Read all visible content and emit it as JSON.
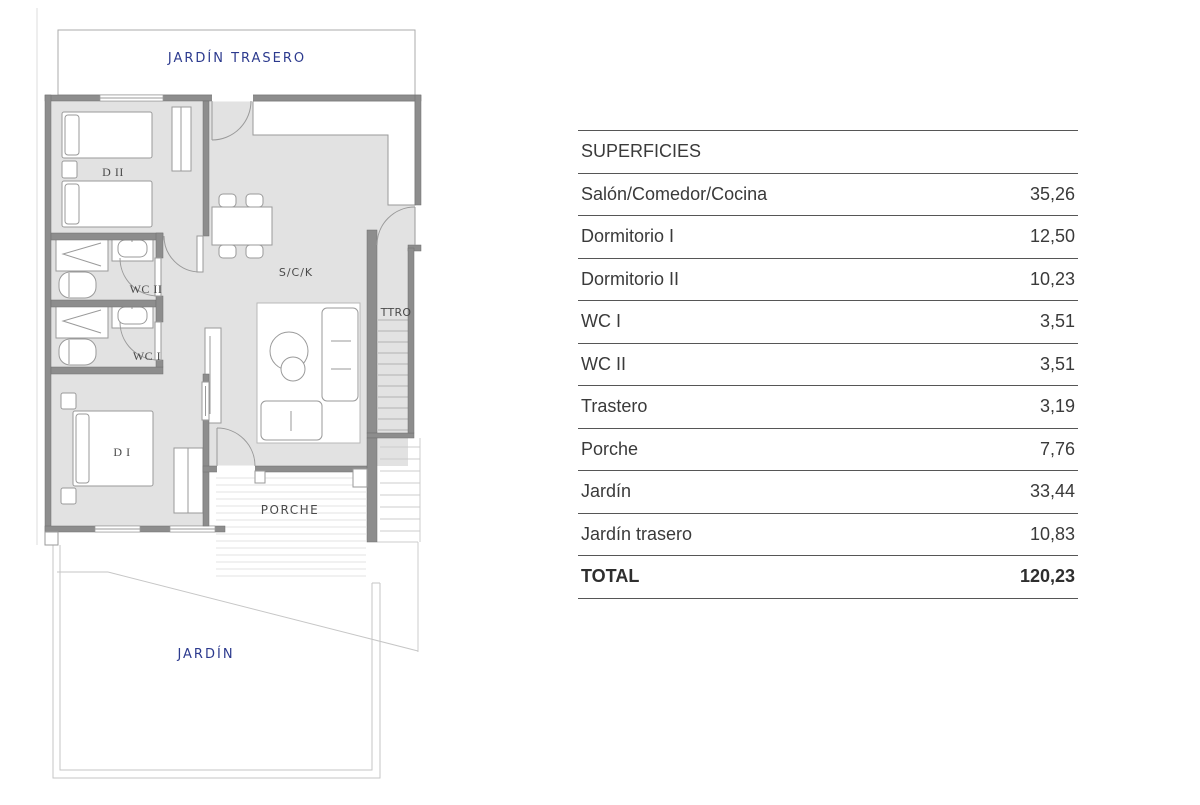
{
  "plan": {
    "labels": {
      "jardin_trasero": "JARDÍN TRASERO",
      "d2": "D II",
      "wc2": "WC II",
      "wc1": "WC I",
      "d1": "D I",
      "sck": "S/C/K",
      "ttro": "TTRO",
      "porche": "PORCHE",
      "jardin": "JARDÍN"
    },
    "colors": {
      "label_blue": "#2c3a8e",
      "label_gray": "#4a4a4a",
      "wall_gray": "#8d8d8d",
      "floor_gray": "#e2e2e2"
    }
  },
  "table": {
    "header": "SUPERFICIES",
    "rows": [
      {
        "label": "Salón/Comedor/Cocina",
        "value": "35,26"
      },
      {
        "label": "Dormitorio I",
        "value": "12,50"
      },
      {
        "label": "Dormitorio II",
        "value": "10,23"
      },
      {
        "label": "WC I",
        "value": "3,51"
      },
      {
        "label": "WC II",
        "value": "3,51"
      },
      {
        "label": "Trastero",
        "value": "3,19"
      },
      {
        "label": "Porche",
        "value": "7,76"
      },
      {
        "label": "Jardín",
        "value": "33,44"
      },
      {
        "label": "Jardín trasero",
        "value": "10,83"
      }
    ],
    "total": {
      "label": "TOTAL",
      "value": "120,23"
    }
  }
}
